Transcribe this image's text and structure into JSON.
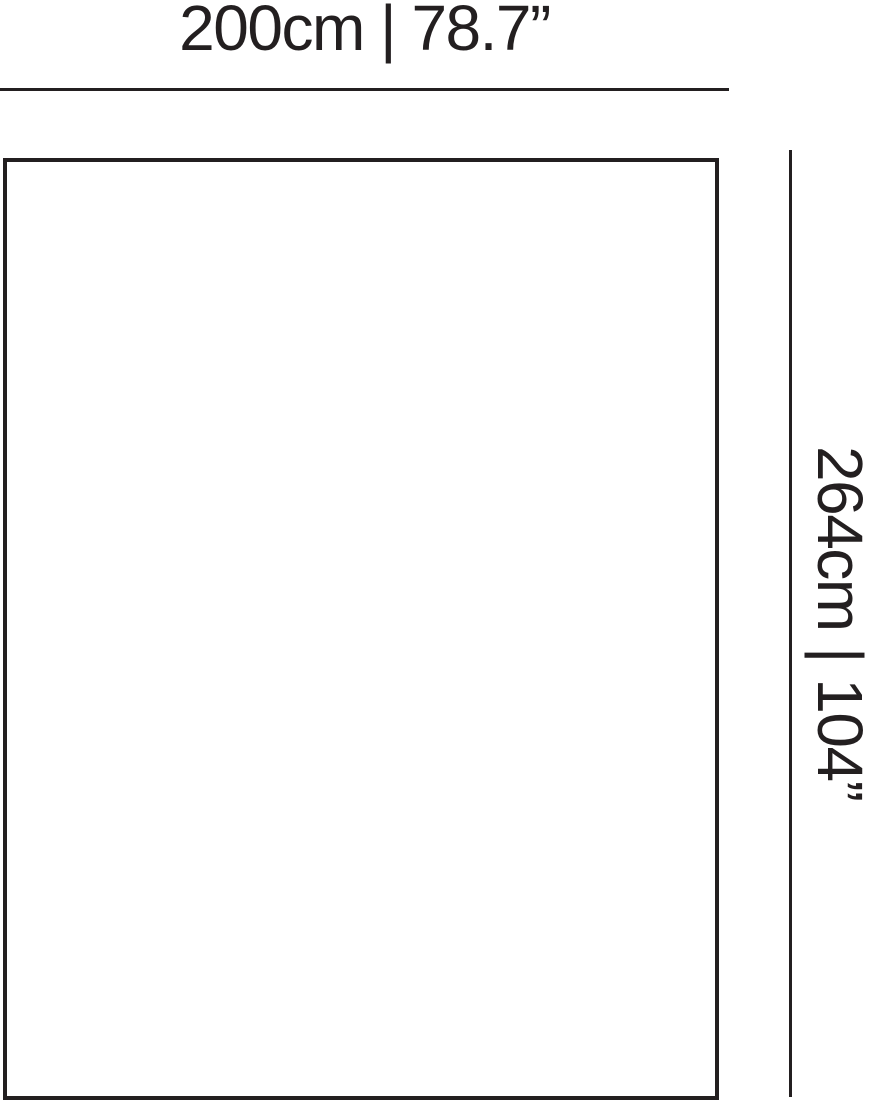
{
  "diagram": {
    "width_label": "200cm | 78.7”",
    "height_label": "264cm | 104”",
    "line_color": "#231f20",
    "background_color": "#ffffff"
  }
}
